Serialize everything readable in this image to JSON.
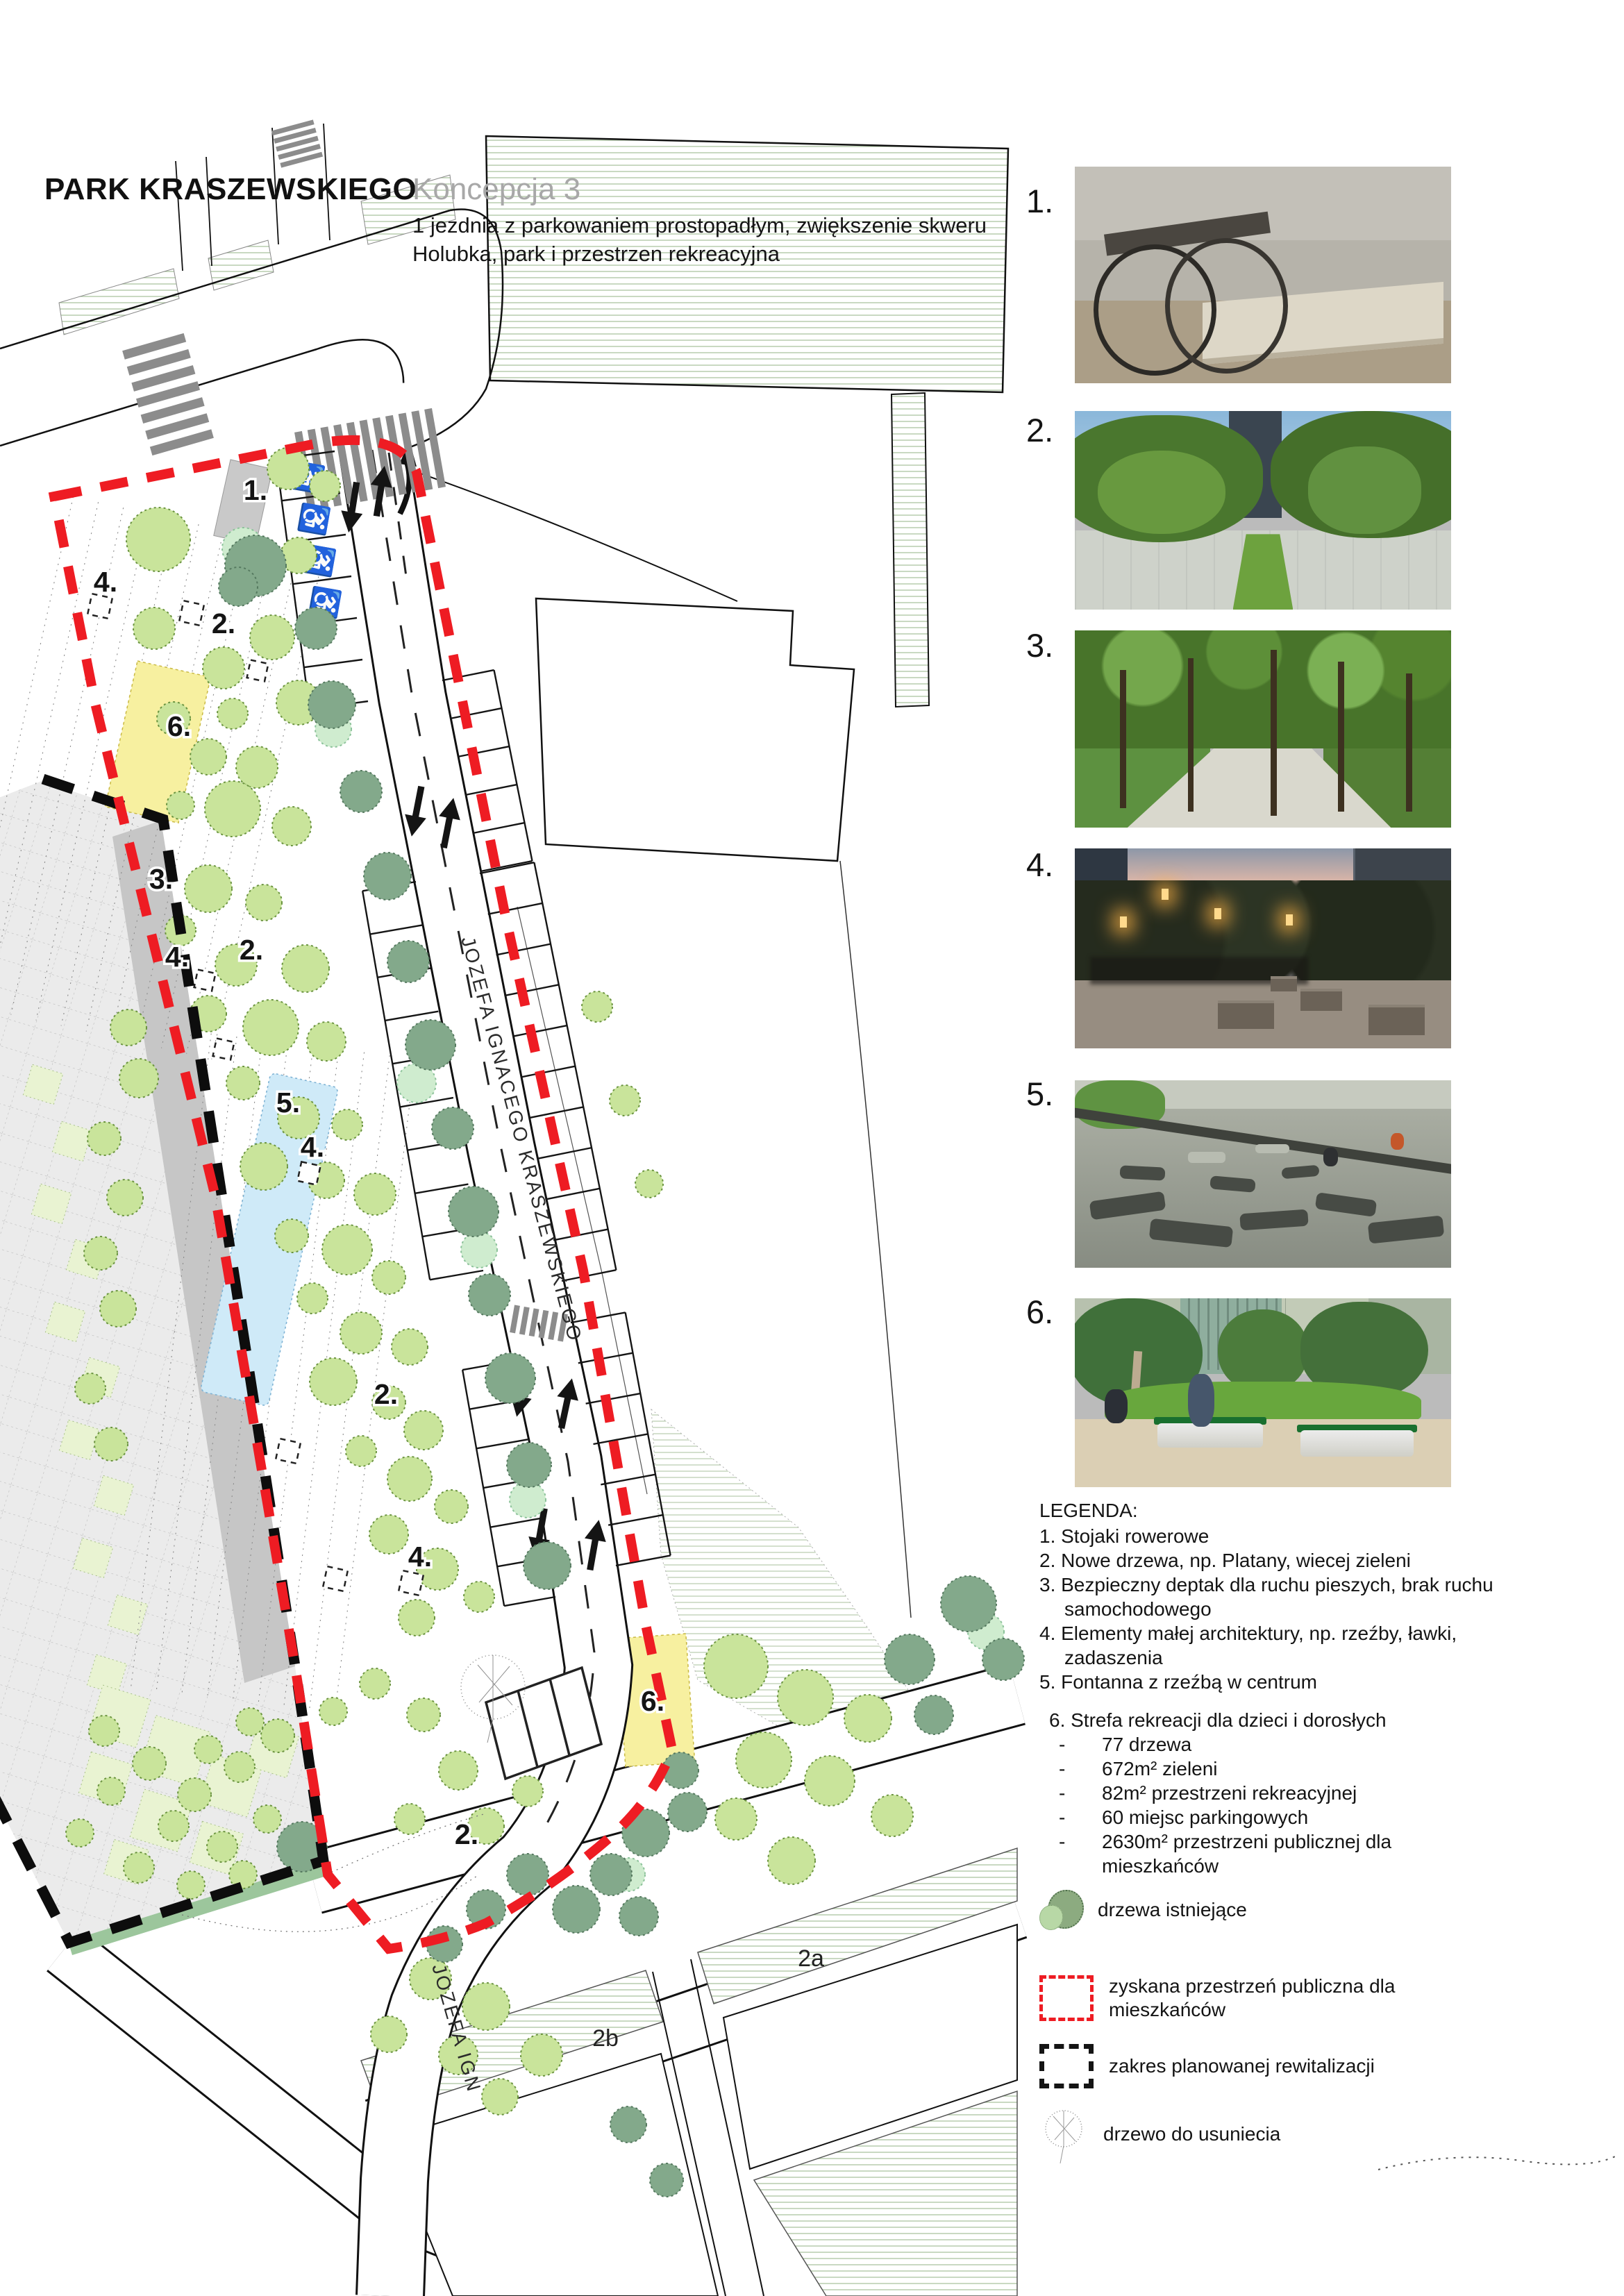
{
  "header": {
    "title": "PARK KRASZEWSKIEGO",
    "concept": "Koncepcja 3",
    "subtitle1": "1 jezdnia z parkowaniem prostopadłym, zwiększenie skweru",
    "subtitle2": "Holubka, park i przestrzen rekreacyjna"
  },
  "photo_numbers": [
    "1.",
    "2.",
    "3.",
    "4.",
    "5.",
    "6."
  ],
  "map": {
    "street_label": "JOZEFA IGNACEGO KRASZEWSKIEGO",
    "street_label_bottom": "JOZEFA IGN",
    "zone_labels": [
      "1.",
      "4.",
      "2.",
      "6.",
      "3.",
      "4.",
      "2.",
      "5.",
      "4.",
      "2.",
      "4.",
      "6.",
      "2."
    ],
    "block_labels": [
      "2a",
      "2b"
    ]
  },
  "legend": {
    "title": "LEGENDA:",
    "dash": "-",
    "items": [
      "1. Stojaki rowerowe",
      "2. Nowe drzewa, np. Platany, wiecej zieleni",
      "3. Bezpieczny deptak dla ruchu pieszych, brak ruchu samochodowego",
      "4. Elementy małej architektury, np. rzeźby, ławki, zadaszenia",
      "5. Fontanna z rzeźbą w centrum"
    ],
    "zone6": {
      "title": "6. Strefa rekreacji dla dzieci i dorosłych",
      "bullets": [
        "77 drzewa",
        "672m² zieleni",
        "82m² przestrzeni rekreacyjnej",
        "60 miejsc parkingowych",
        "2630m² przestrzeni publicznej dla mieszkańców"
      ]
    },
    "symbols": [
      "drzewa istniejące",
      "zyskana przestrzeń publiczna dla mieszkańców",
      "zakres planowanej rewitalizacji",
      "drzewo do usuniecia"
    ]
  }
}
